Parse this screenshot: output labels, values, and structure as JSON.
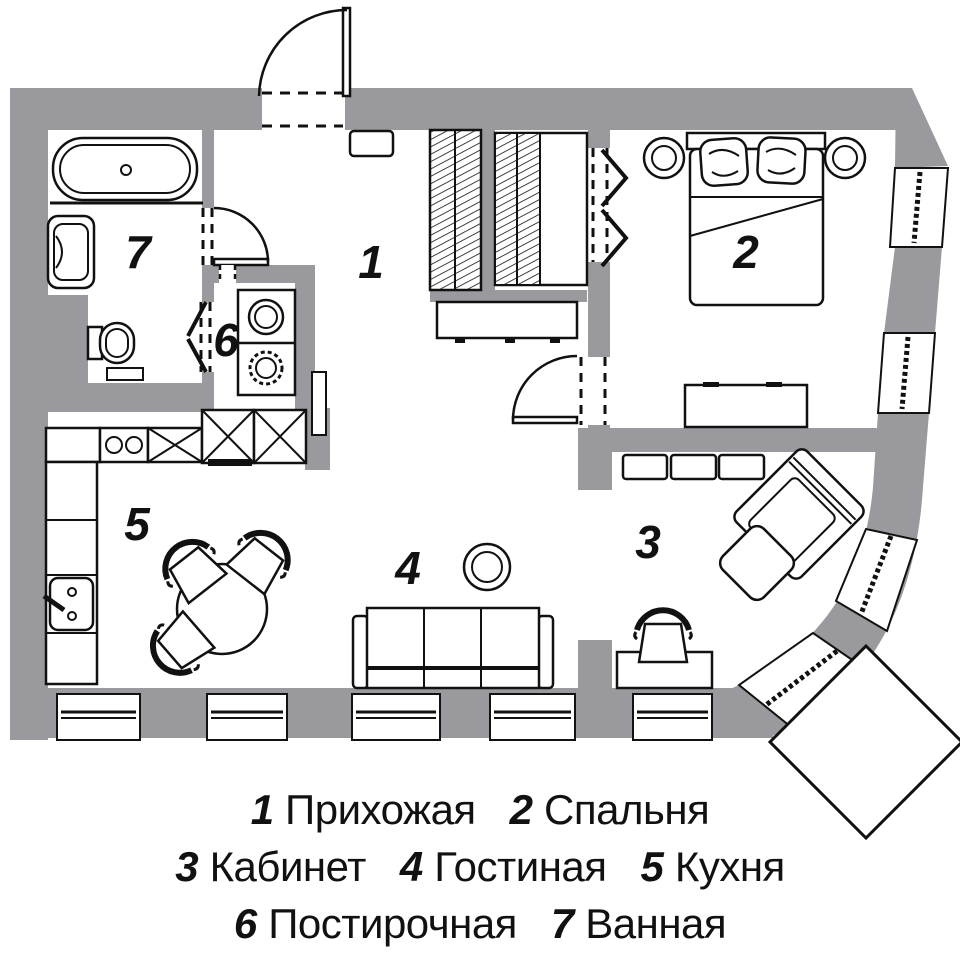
{
  "title": "Apartment floor plan",
  "colors": {
    "wall": "#9a9a9e",
    "line": "#111111",
    "bg": "#ffffff"
  },
  "rooms": [
    {
      "num": "1",
      "name": "Прихожая"
    },
    {
      "num": "2",
      "name": "Спальня"
    },
    {
      "num": "3",
      "name": "Кабинет"
    },
    {
      "num": "4",
      "name": "Гостиная"
    },
    {
      "num": "5",
      "name": "Кухня"
    },
    {
      "num": "6",
      "name": "Постирочная"
    },
    {
      "num": "7",
      "name": "Ванная"
    }
  ]
}
